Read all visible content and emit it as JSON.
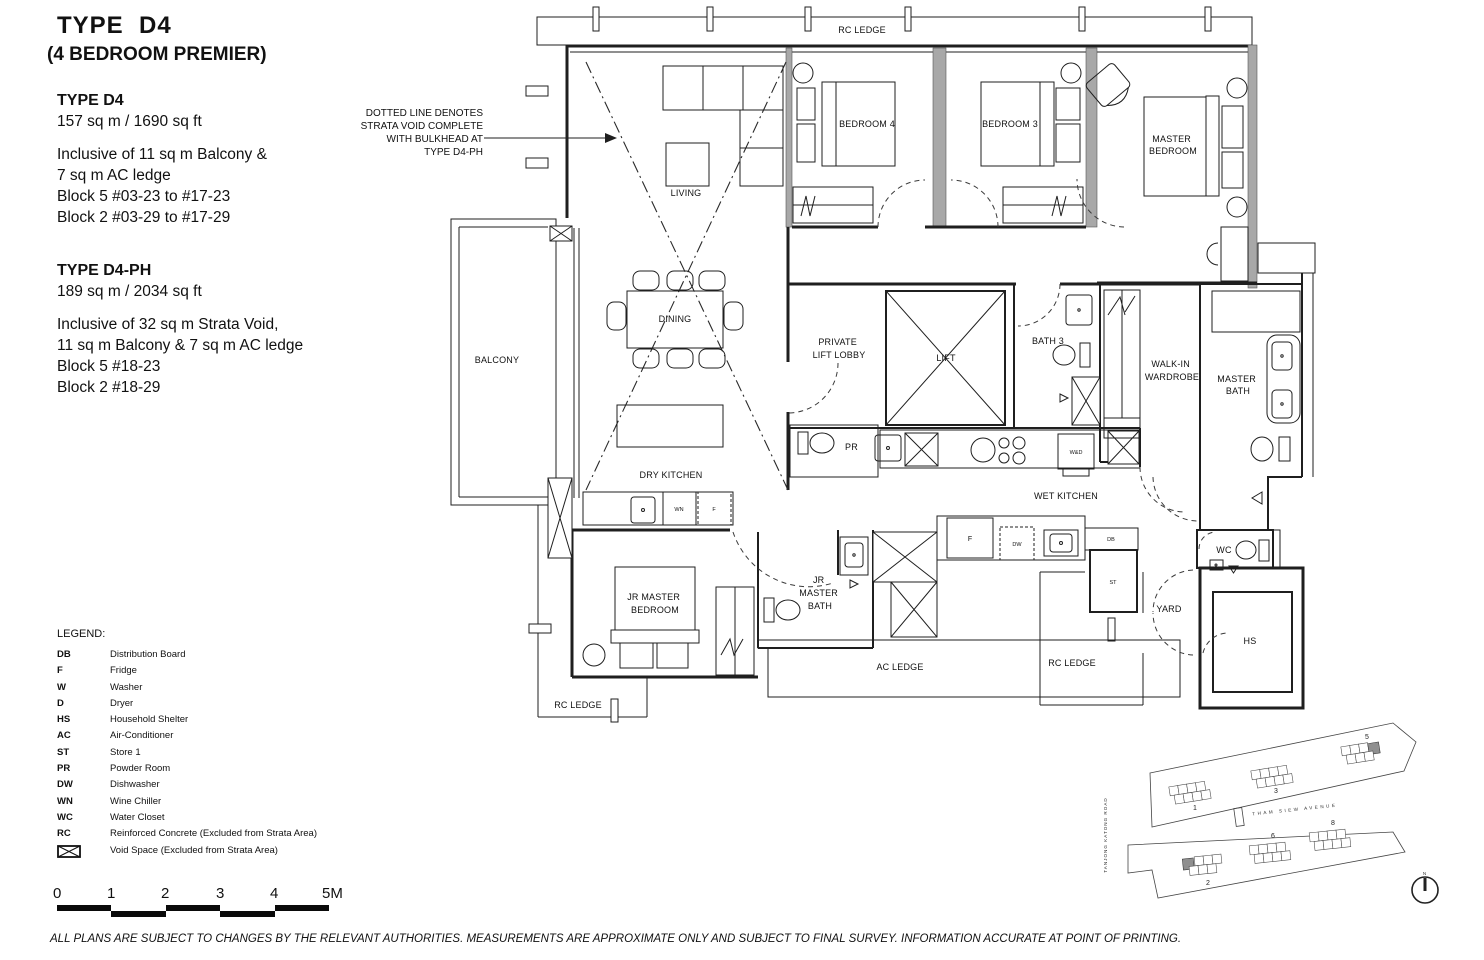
{
  "title": {
    "line1": "TYPE  D4",
    "line2": "(4 BEDROOM PREMIER)"
  },
  "spec_d4": {
    "heading": "TYPE D4",
    "area": "157 sq m / 1690 sq ft",
    "lines": [
      "Inclusive of 11 sq m Balcony &",
      "7 sq m AC ledge",
      "Block 5 #03-23 to #17-23",
      "Block 2 #03-29 to #17-29"
    ]
  },
  "spec_d4ph": {
    "heading": "TYPE D4-PH",
    "area": "189 sq m / 2034 sq ft",
    "lines": [
      "Inclusive of 32 sq m Strata Void,",
      "11 sq m Balcony & 7 sq m AC ledge",
      "Block 5 #18-23",
      "Block 2 #18-29"
    ]
  },
  "annotation": {
    "lines": [
      "DOTTED LINE DENOTES",
      "STRATA VOID COMPLETE",
      "WITH BULKHEAD AT",
      "TYPE D4-PH"
    ]
  },
  "plan": {
    "labels": {
      "rc_ledge_top": "RC LEDGE",
      "living": "LIVING",
      "bedroom4": "BEDROOM 4",
      "bedroom3": "BEDROOM 3",
      "master_bedroom": [
        "MASTER",
        "BEDROOM"
      ],
      "balcony": "BALCONY",
      "dining": "DINING",
      "private_lift_lobby": [
        "PRIVATE",
        "LIFT LOBBY"
      ],
      "lift": "LIFT",
      "bath3": "BATH 3",
      "walk_in_wardrobe": [
        "WALK-IN",
        "WARDROBE"
      ],
      "master_bath": [
        "MASTER",
        "BATH"
      ],
      "pr": "PR",
      "dry_kitchen": "DRY KITCHEN",
      "wet_kitchen": "WET KITCHEN",
      "wd": "W&D",
      "wn": "WN",
      "f_dry": "F",
      "f_wet": "F",
      "dw": "DW",
      "db": "DB",
      "st": "ST",
      "jr_master_bedroom": [
        "JR MASTER",
        "BEDROOM"
      ],
      "jr_master_bath": [
        "JR",
        "MASTER",
        "BATH"
      ],
      "ac_ledge": "AC LEDGE",
      "rc_ledge_bottom_left": "RC LEDGE",
      "rc_ledge_bottom_right": "RC LEDGE",
      "yard": "YARD",
      "wc": "WC",
      "hs": "HS"
    }
  },
  "site_plan": {
    "blocks": [
      "1",
      "3",
      "5",
      "2",
      "6",
      "8"
    ],
    "road_horizontal": "THAM SIEW AVENUE",
    "road_vertical": "TANJONG KATONG ROAD",
    "north_label": "N"
  },
  "legend": {
    "title": "LEGEND:",
    "items": [
      {
        "code": "DB",
        "desc": "Distribution Board"
      },
      {
        "code": "F",
        "desc": "Fridge"
      },
      {
        "code": "W",
        "desc": "Washer"
      },
      {
        "code": "D",
        "desc": "Dryer"
      },
      {
        "code": "HS",
        "desc": "Household Shelter"
      },
      {
        "code": "AC",
        "desc": "Air-Conditioner"
      },
      {
        "code": "ST",
        "desc": "Store 1"
      },
      {
        "code": "PR",
        "desc": "Powder Room"
      },
      {
        "code": "DW",
        "desc": "Dishwasher"
      },
      {
        "code": "WN",
        "desc": "Wine Chiller"
      },
      {
        "code": "WC",
        "desc": "Water Closet"
      },
      {
        "code": "RC",
        "desc": "Reinforced Concrete (Excluded from Strata Area)"
      }
    ],
    "void_item": {
      "desc": "Void Space (Excluded from Strata Area)"
    }
  },
  "scalebar": {
    "labels": [
      "0",
      "1",
      "2",
      "3",
      "4",
      "5M"
    ]
  },
  "disclaimer": "ALL PLANS ARE SUBJECT TO CHANGES BY THE RELEVANT AUTHORITIES. MEASUREMENTS ARE APPROXIMATE ONLY AND SUBJECT TO FINAL SURVEY. INFORMATION ACCURATE AT POINT OF PRINTING.",
  "colors": {
    "background": "#ffffff",
    "line": "#1f1f1f",
    "party_wall": "#a8a8a8",
    "shaded_unit": "#8f8f8f"
  }
}
